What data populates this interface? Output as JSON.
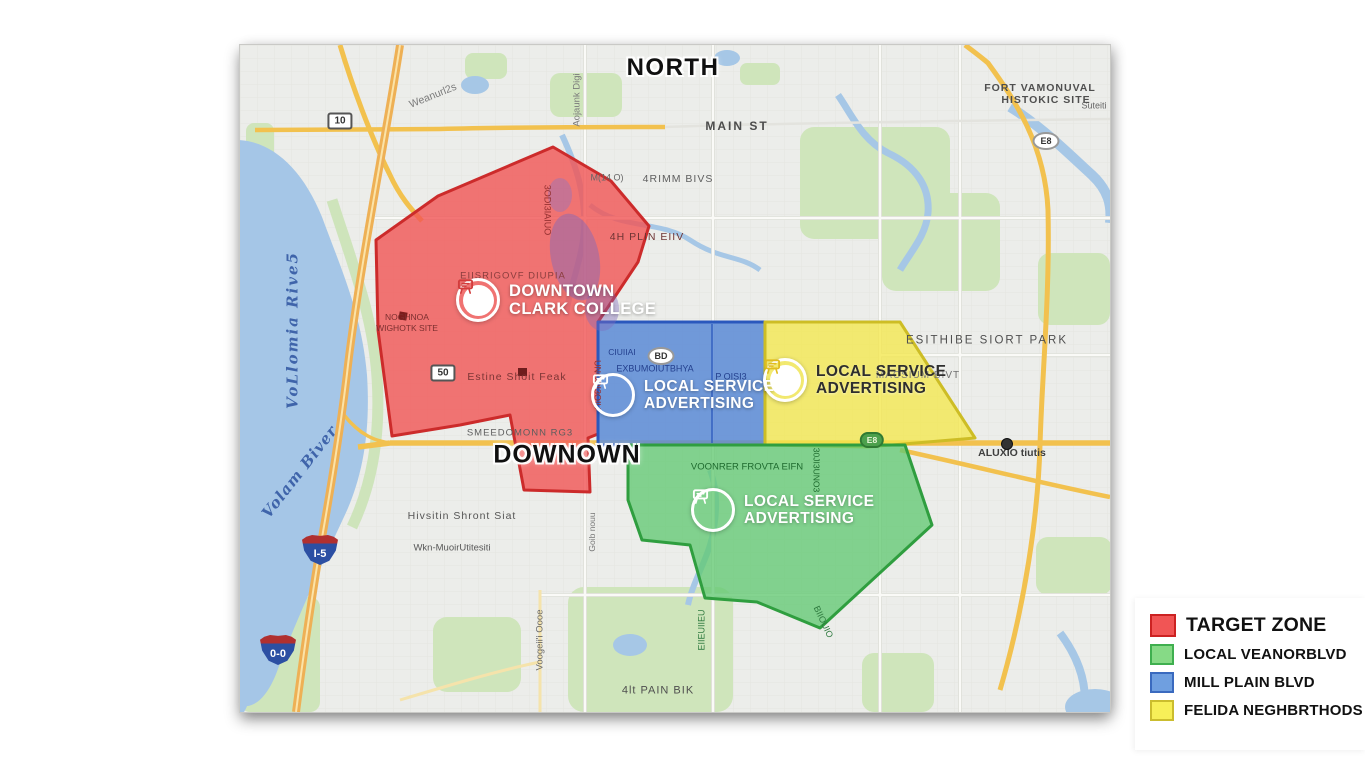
{
  "page": {
    "background": "#ffffff"
  },
  "legend": {
    "items": [
      {
        "label": "TARGET ZONE",
        "fill": "#f15555",
        "border": "#cc2222",
        "size": "large"
      },
      {
        "label": "LOCAL VEANORBLVD",
        "fill": "#86da86",
        "border": "#3faf4f",
        "size": "normal"
      },
      {
        "label": "MILL PLAIN BLVD",
        "fill": "#6f9fe0",
        "border": "#3a6abf",
        "size": "normal"
      },
      {
        "label": "FELIDA NEGHBRTHODS",
        "fill": "#f7ef58",
        "border": "#cbbd2e",
        "size": "normal"
      }
    ]
  },
  "map": {
    "colors": {
      "water": "#a5c6e7",
      "park": "#cfe5bb",
      "road_major": "#f2c14e",
      "base": "#ecedea"
    },
    "zones": [
      {
        "id": "red",
        "name": "downtown-clark-college-zone",
        "fill": "#f15454",
        "stroke": "#cc2b2b",
        "fill_opacity": 0.8,
        "label": {
          "line1": "DOWNTOWN",
          "line2": "CLARK COLLEGE"
        },
        "icon_x": 238,
        "icon_y": 255,
        "icon_variant": "disc",
        "glyph_color": "#d23c3c"
      },
      {
        "id": "blue",
        "name": "mill-plain-blvd-zone",
        "fill": "#5b8ad6",
        "stroke": "#2a58bd",
        "fill_opacity": 0.85,
        "label": {
          "line1": "LOCAL SERVICE",
          "line2": "ADVERTISING"
        },
        "icon_x": 373,
        "icon_y": 350,
        "icon_variant": "ring",
        "glyph_color": "#ffffff"
      },
      {
        "id": "yellow",
        "name": "felida-neighborhoods-zone",
        "fill": "#f4e84d",
        "stroke": "#cdbd25",
        "fill_opacity": 0.78,
        "label": {
          "line1": "LOCAL SERVICE",
          "line2": "ADVERTISING"
        },
        "icon_x": 545,
        "icon_y": 335,
        "icon_variant": "disc",
        "glyph_color": "#e0bc20"
      },
      {
        "id": "green",
        "name": "local-veanor-blvd-zone",
        "fill": "#63c973",
        "stroke": "#2f9e3f",
        "fill_opacity": 0.78,
        "label": {
          "line1": "LOCAL SERVICE",
          "line2": "ADVERTISING"
        },
        "icon_x": 473,
        "icon_y": 465,
        "icon_variant": "ring",
        "glyph_color": "#ffffff"
      }
    ],
    "labels": [
      {
        "t": "NORTH",
        "x": 433,
        "y": 23,
        "s": 24,
        "w": 800,
        "c": "#101010",
        "ls": 1.5,
        "outline": true,
        "n": "north-label"
      },
      {
        "t": "DOWNOWN",
        "x": 327,
        "y": 410,
        "s": 25,
        "w": 800,
        "c": "#101010",
        "ls": 1,
        "outline": true,
        "n": "downtown-label"
      },
      {
        "t": "MAIN ST",
        "x": 497,
        "y": 81,
        "s": 12,
        "w": 600,
        "c": "#4c4c4c",
        "ls": 2
      },
      {
        "t": "Weanurl2s",
        "x": 193,
        "y": 51,
        "s": 10.5,
        "c": "#7b7b7b",
        "r": -22
      },
      {
        "t": "Aojaunk Digi",
        "x": 337,
        "y": 55,
        "s": 9.5,
        "c": "#7b7b7b",
        "r": -90
      },
      {
        "t": "4RIMM BIVS",
        "x": 438,
        "y": 134,
        "s": 10.5,
        "c": "#5f5f5f",
        "ls": 1
      },
      {
        "t": "M(14 O)",
        "x": 367,
        "y": 133,
        "s": 9,
        "c": "#666666"
      },
      {
        "t": "4H PLIN EIIV",
        "x": 407,
        "y": 192,
        "s": 10.5,
        "c": "#6e3434",
        "ls": 1
      },
      {
        "t": "EIISRIGOVF DIUPIA",
        "x": 273,
        "y": 231,
        "s": 9.5,
        "c": "#8a3d3d",
        "ls": 1
      },
      {
        "t": "NOGHNOA",
        "x": 167,
        "y": 272,
        "s": 8.5,
        "c": "#7c2f2f"
      },
      {
        "t": "WIGHOTK SITE",
        "x": 167,
        "y": 283,
        "s": 8.5,
        "c": "#7c2f2f"
      },
      {
        "t": "Estine Shoit Feak",
        "x": 277,
        "y": 332,
        "s": 10.5,
        "c": "#7c3535",
        "ls": 1
      },
      {
        "t": "SMEEDOMONN RG3",
        "x": 280,
        "y": 388,
        "s": 9.5,
        "c": "#5d5d5d",
        "ls": 1
      },
      {
        "t": "ESITHIBE SIORT PARK",
        "x": 747,
        "y": 296,
        "s": 11.5,
        "c": "#4f4f4f",
        "ls": 2
      },
      {
        "t": "MACSIUM BIVT",
        "x": 678,
        "y": 331,
        "s": 10,
        "c": "#707070",
        "ls": 1
      },
      {
        "t": "ALUXIO tiutis",
        "x": 772,
        "y": 408,
        "s": 10.5,
        "w": 600,
        "c": "#3f3f3f"
      },
      {
        "t": "FORT VAMONUVAL",
        "x": 800,
        "y": 43,
        "s": 10.5,
        "w": 600,
        "c": "#4f4f4f",
        "ls": 1
      },
      {
        "t": "HISTOKIC SITE",
        "x": 806,
        "y": 55,
        "s": 10.5,
        "w": 600,
        "c": "#4f4f4f",
        "ls": 1
      },
      {
        "t": "Suteiti",
        "x": 854,
        "y": 61,
        "s": 9,
        "c": "#666666"
      },
      {
        "t": "Hivsitin Shront Siat",
        "x": 222,
        "y": 471,
        "s": 10.5,
        "c": "#555555",
        "ls": 1
      },
      {
        "t": "Wkn-MuoirUtitesiti",
        "x": 212,
        "y": 503,
        "s": 9.5,
        "c": "#585858"
      },
      {
        "t": "4lt PAIN BIK",
        "x": 418,
        "y": 646,
        "s": 11,
        "c": "#4f4f4f",
        "ls": 1
      },
      {
        "t": "Voogeii'i Oooe",
        "x": 300,
        "y": 595,
        "s": 9.5,
        "c": "#6a6a6a",
        "r": -90
      },
      {
        "t": "Goib nouu",
        "x": 352,
        "y": 487,
        "s": 8.5,
        "c": "#777777",
        "r": -90
      },
      {
        "t": "EXBUMOIUTBHYA",
        "x": 415,
        "y": 324,
        "s": 9,
        "c": "#24408e"
      },
      {
        "t": "P OISI3",
        "x": 491,
        "y": 332,
        "s": 9,
        "c": "#24408e"
      },
      {
        "t": "CIUIIAI",
        "x": 382,
        "y": 307,
        "s": 8.5,
        "c": "#24408e"
      },
      {
        "t": "VOONRER FROVTA EIFN",
        "x": 507,
        "y": 422,
        "s": 9.5,
        "c": "#1e6a2e"
      },
      {
        "t": "30JI3UNO3",
        "x": 576,
        "y": 425,
        "s": 8.5,
        "c": "#1e6a2e",
        "r": 90
      },
      {
        "t": "3ODI3IAIUO",
        "x": 307,
        "y": 165,
        "s": 9,
        "c": "#943030",
        "r": 90
      },
      {
        "t": "UNODI3OIU",
        "x": 357,
        "y": 340,
        "s": 9,
        "c": "#943030",
        "r": 90
      },
      {
        "t": "EIIEUIIEU",
        "x": 462,
        "y": 585,
        "s": 9,
        "c": "#2f7a3f",
        "r": -90
      },
      {
        "t": "BIIOUIO",
        "x": 583,
        "y": 577,
        "s": 9,
        "c": "#2f7a3f",
        "r": 65
      },
      {
        "t": "VoLlomia Rive5",
        "x": 53,
        "y": 285,
        "s": 15,
        "c": "#3f64aa",
        "r": -90,
        "serif": true,
        "ls": 2,
        "n": "river-label"
      },
      {
        "t": "Volam Biver",
        "x": 60,
        "y": 427,
        "s": 15,
        "c": "#3f64aa",
        "r": -52,
        "serif": true,
        "ls": 1,
        "n": "river-label"
      }
    ],
    "shields": [
      {
        "type": "rect",
        "t": "10",
        "x": 100,
        "y": 76
      },
      {
        "type": "rect",
        "t": "50",
        "x": 203,
        "y": 328
      },
      {
        "type": "oval",
        "t": "BD",
        "x": 421,
        "y": 311
      },
      {
        "type": "oval",
        "t": "E8",
        "x": 806,
        "y": 96
      },
      {
        "type": "pill",
        "t": "E8",
        "x": 632,
        "y": 395
      },
      {
        "type": "interstate",
        "t": "I-5",
        "x": 80,
        "y": 505
      },
      {
        "type": "interstate",
        "t": "0-0",
        "x": 38,
        "y": 605
      },
      {
        "type": "dot",
        "t": "",
        "x": 767,
        "y": 399
      }
    ]
  }
}
